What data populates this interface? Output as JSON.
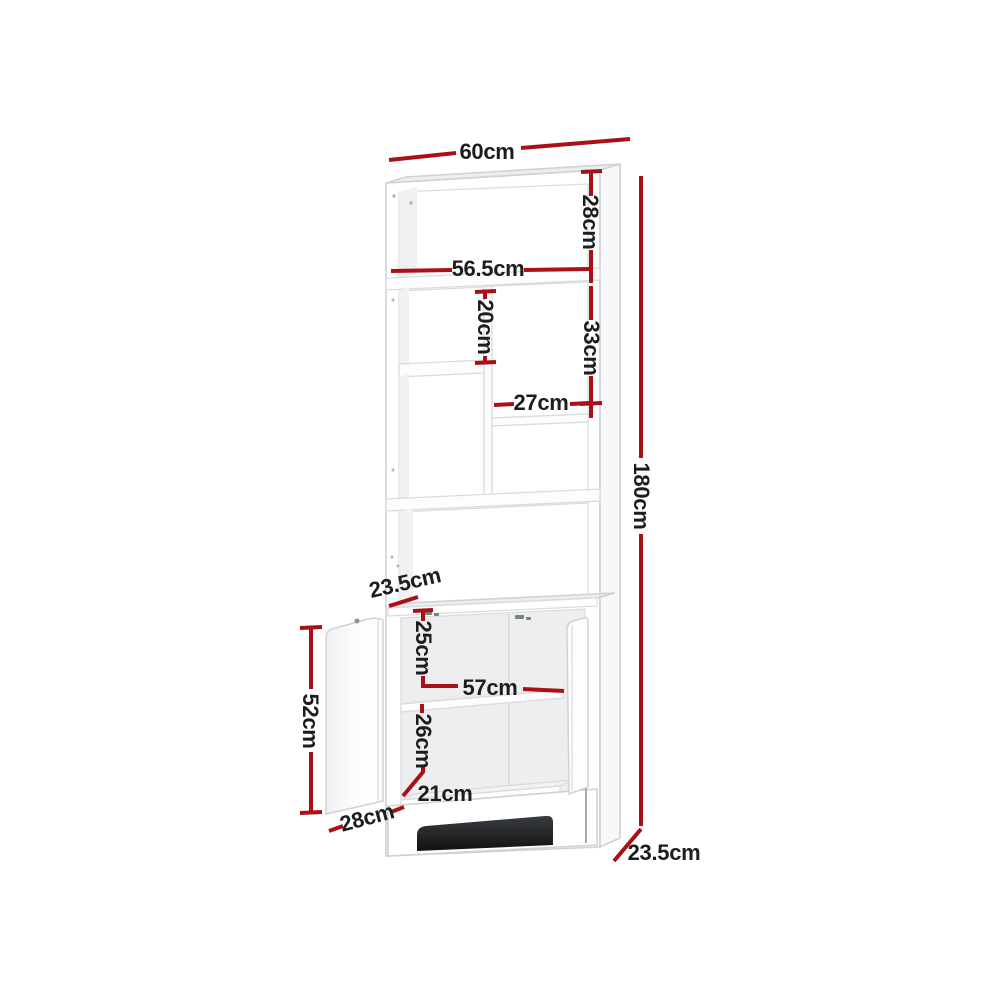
{
  "diagram": {
    "type": "product-dimension-diagram",
    "subject": "display-shelf-with-two-door-cabinet",
    "unit": "cm",
    "colors": {
      "accent": "#a91116",
      "text": "#1d1d1f",
      "outline": "#ced2d5",
      "shadow_dark": "#17181a",
      "background": "#ffffff"
    },
    "dimensions": [
      {
        "id": "top-width",
        "label": "60cm",
        "orientation": "horizontal"
      },
      {
        "id": "top-cubby-height",
        "label": "28cm",
        "orientation": "vertical"
      },
      {
        "id": "inner-shelf-width",
        "label": "56.5cm",
        "orientation": "horizontal"
      },
      {
        "id": "left-cubby-height",
        "label": "20cm",
        "orientation": "vertical"
      },
      {
        "id": "right-cubby-height",
        "label": "33cm",
        "orientation": "vertical"
      },
      {
        "id": "right-cubby-width",
        "label": "27cm",
        "orientation": "horizontal"
      },
      {
        "id": "overall-height",
        "label": "180cm",
        "orientation": "vertical"
      },
      {
        "id": "shelf-unit-depth",
        "label": "23.5cm",
        "orientation": "diagonal"
      },
      {
        "id": "cabinet-upper-inner-height",
        "label": "25cm",
        "orientation": "vertical"
      },
      {
        "id": "cabinet-inner-width",
        "label": "57cm",
        "orientation": "horizontal"
      },
      {
        "id": "cabinet-lower-inner-height",
        "label": "26cm",
        "orientation": "vertical"
      },
      {
        "id": "cabinet-floor-depth",
        "label": "21cm",
        "orientation": "horizontal"
      },
      {
        "id": "door-width",
        "label": "28cm",
        "orientation": "diagonal"
      },
      {
        "id": "door-height",
        "label": "52cm",
        "orientation": "vertical"
      },
      {
        "id": "cabinet-depth",
        "label": "23.5cm",
        "orientation": "diagonal"
      }
    ]
  }
}
